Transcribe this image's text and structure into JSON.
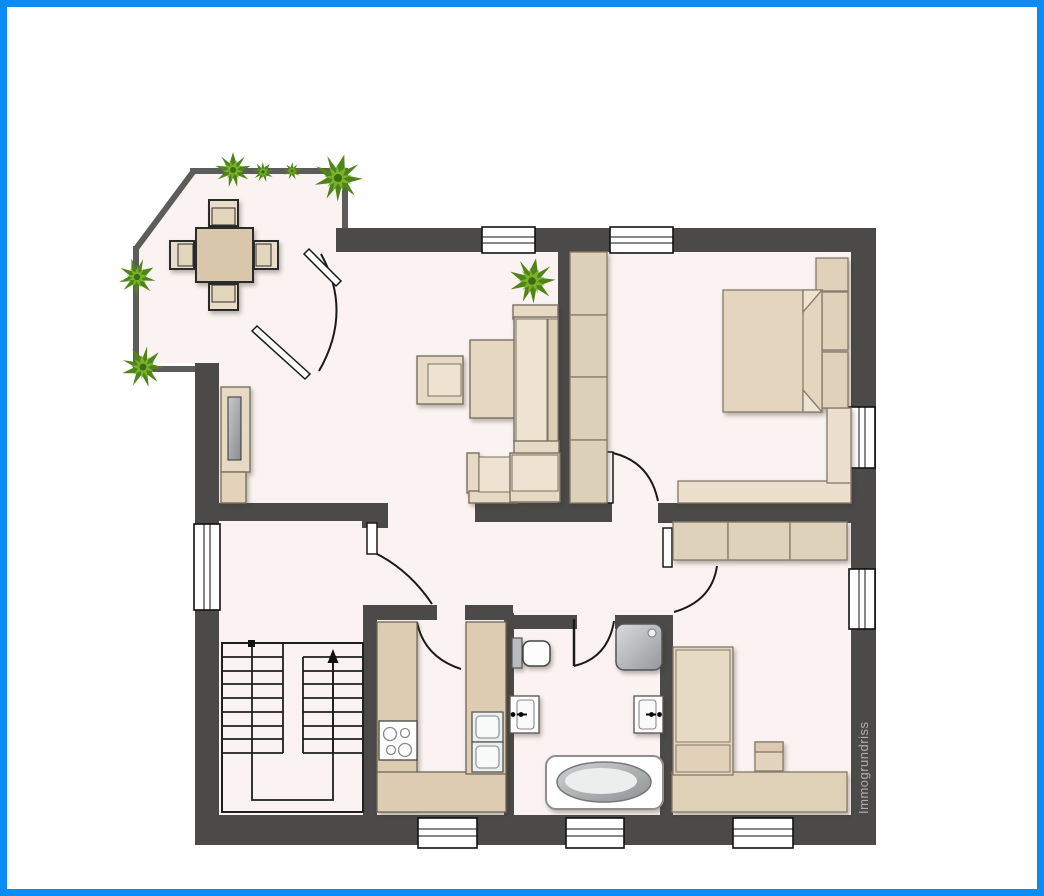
{
  "watermark": "Immogrundriss",
  "palette": {
    "border_blue": "#0a8cf4",
    "wall_dark": "#4b4a48",
    "terrace_wall": "#5c5c5a",
    "floor": "#fbf3f1",
    "furniture_light": "#e7dac4",
    "furniture_pale": "#eee2d0",
    "furniture_mid": "#dccbb1",
    "counter_beige": "#ddccb2",
    "plant_dark_green": "#4e8418",
    "plant_light_green": "#7ab32a",
    "fixture_white": "#ffffff",
    "metal_gray": "#a8abad",
    "watermark_gray": "#b0aeac"
  },
  "plan": {
    "type": "apartment-floorplan",
    "window_count": 8,
    "door_count": 6,
    "rooms": [
      {
        "name": "terrace",
        "furniture": [
          "dining-table",
          "chair-top",
          "chair-bottom",
          "chair-left",
          "chair-right",
          "plants"
        ]
      },
      {
        "name": "living-room",
        "furniture": [
          "corner-sofa",
          "coffee-table",
          "armchair",
          "tv-sideboard",
          "plant"
        ]
      },
      {
        "name": "bedroom-top-right",
        "furniture": [
          "double-bed",
          "wardrobe-4-sections",
          "bedside-tables",
          "l-sideboard"
        ]
      },
      {
        "name": "bedroom-bottom-right",
        "furniture": [
          "single-bed",
          "wardrobe-3-sections",
          "stool",
          "sideboard"
        ]
      },
      {
        "name": "kitchen",
        "furniture": [
          "u-shaped-counter",
          "stove-4-burners",
          "double-sink"
        ]
      },
      {
        "name": "bathroom",
        "furniture": [
          "toilet",
          "shower",
          "washbasin-left",
          "washbasin-right",
          "bathtub"
        ]
      },
      {
        "name": "staircase-hall",
        "furniture": [
          "u-staircase",
          "direction-arrow"
        ]
      },
      {
        "name": "hallway",
        "furniture": []
      }
    ]
  }
}
